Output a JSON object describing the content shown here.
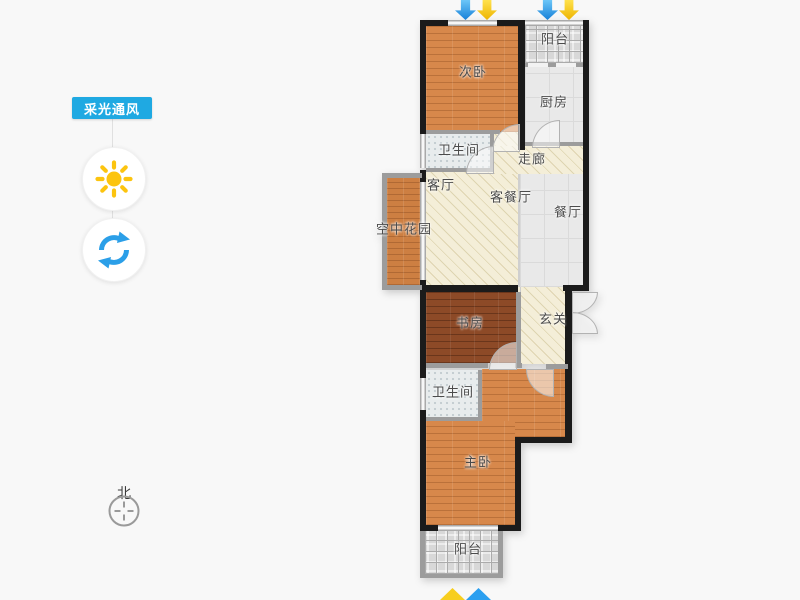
{
  "panel": {
    "title": "采光通风",
    "sun_icon": "sun-icon",
    "rotate_icon": "rotate-refresh-icon"
  },
  "compass": {
    "north_label": "北"
  },
  "floor_plan": {
    "rooms": [
      {
        "label": "阳台"
      },
      {
        "label": "次卧"
      },
      {
        "label": "厨房"
      },
      {
        "label": "卫生间"
      },
      {
        "label": "走廊"
      },
      {
        "label": "客厅"
      },
      {
        "label": "客餐厅"
      },
      {
        "label": "餐厅"
      },
      {
        "label": "空中花园"
      },
      {
        "label": "书房"
      },
      {
        "label": "玄关"
      },
      {
        "label": "卫生间"
      },
      {
        "label": "主卧"
      },
      {
        "label": "阳台"
      }
    ]
  },
  "colors": {
    "accent_blue": "#1fa9e2",
    "sun_yellow": "#fcc40f",
    "arrow_blue": "#2196f3",
    "arrow_yellow": "#fdd535",
    "wall_black": "#1b1b1b"
  }
}
